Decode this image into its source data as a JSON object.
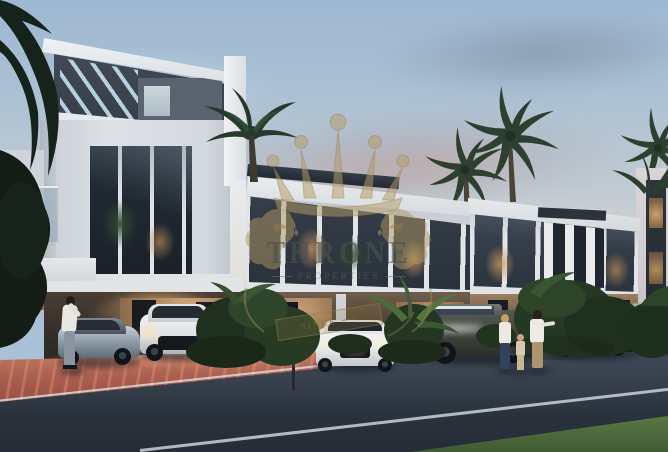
{
  "scene": {
    "type": "architectural-dusk-render",
    "subject": "modern two-storey townhouse row with carports, parked cars, palms and pedestrians at dusk",
    "palette": {
      "sky_top": "#9db8d2",
      "sky_horizon": "#ccd2d6",
      "building_white": "#e6e9ec",
      "accent_dark": "#39424e",
      "warm_interior_light": "#c9a06c",
      "road": "#343d4a",
      "paver_red": "#a65a4b",
      "grass": "#4e6b3d",
      "foliage": "#26392a"
    }
  },
  "watermark": {
    "brand": "THRONE",
    "subtitle": "PROPERTIES",
    "ribbon": "SINCE",
    "gold": "#b5995c",
    "icons": [
      "crown-icon",
      "lion-left-icon",
      "lion-right-icon",
      "ribbon-banner"
    ]
  }
}
